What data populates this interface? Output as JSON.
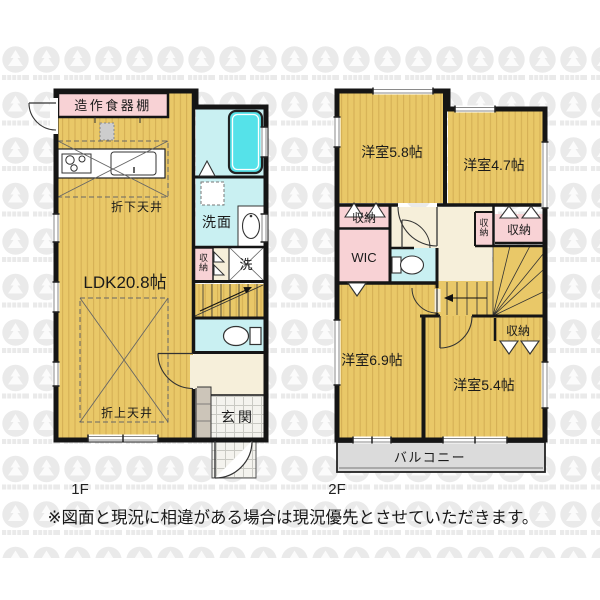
{
  "floor1": {
    "name": "1F",
    "labels": {
      "cupboard": "造作食器棚",
      "lowered_ceiling": "折下天井",
      "ldk": "LDK20.8帖",
      "raised_ceiling": "折上天井",
      "washroom": "洗面",
      "closet": "収納",
      "laundry": "洗",
      "entrance": "玄関"
    }
  },
  "floor2": {
    "name": "2F",
    "labels": {
      "room_5_8": "洋室5.8帖",
      "room_4_7": "洋室4.7帖",
      "closet_a": "収納",
      "wic": "WIC",
      "closet_b": "収納",
      "closet_c": "収納",
      "closet_d": "収納",
      "room_6_9": "洋室6.9帖",
      "room_5_4": "洋室5.4帖",
      "balcony": "バルコニー"
    }
  },
  "footer": {
    "disclaimer": "※図面と現況に相違がある場合は現況優先とさせていただきます。"
  },
  "palette": {
    "wood_floor": "#E9C868",
    "wood_stripe": "#CFA94F",
    "water_area": "#C9F0F2",
    "bathtub": "#55E2E9",
    "closet_pink": "#F8D2D5",
    "hallway_cream": "#F6EFDA",
    "balcony_gray": "#DBDBDB",
    "wall_black": "#151515"
  }
}
